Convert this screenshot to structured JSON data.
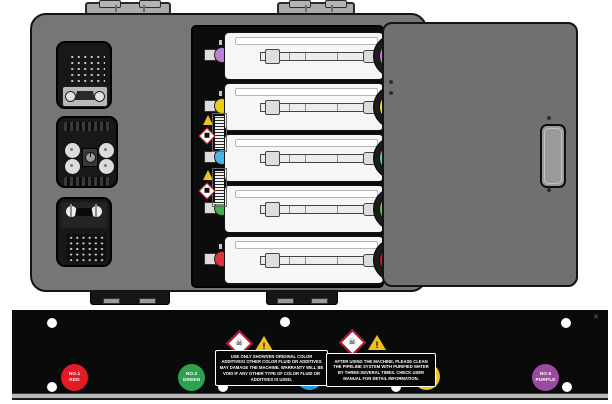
{
  "machine": {
    "type_note": "five-color fluid pump bay diagram",
    "cartridge_rows": [
      {
        "position": 1,
        "color_name": "purple",
        "connector_hex": "#d46fe3",
        "ball_hex": "#bb7fd6"
      },
      {
        "position": 2,
        "color_name": "yellow",
        "connector_hex": "#f0e40e",
        "ball_hex": "#e6cf12"
      },
      {
        "position": 3,
        "color_name": "cyan",
        "connector_hex": "#38d6d6",
        "ball_hex": "#4db4e6"
      },
      {
        "position": 4,
        "color_name": "green",
        "connector_hex": "#67c531",
        "ball_hex": "#3fae4d"
      },
      {
        "position": 5,
        "color_name": "red",
        "connector_hex": "#e0101f",
        "ball_hex": "#e03340"
      }
    ]
  },
  "bottom_panel": {
    "background": "#0a0a0a",
    "ports": [
      {
        "line1": "NO.1",
        "line2": "RED",
        "hex": "#e21b24"
      },
      {
        "line1": "NO.2",
        "line2": "GREEN",
        "hex": "#2ea14e"
      },
      {
        "line1": "NO.3",
        "line2": "BLUE",
        "hex": "#2a9ddd"
      },
      {
        "line1": "NO.4",
        "line2": "YELLOW",
        "hex": "#ecc426"
      },
      {
        "line1": "NO.5",
        "line2": "PURPLE",
        "hex": "#9a4ba0"
      }
    ],
    "warning_labels": [
      {
        "text": "USE ONLY SHOWVEN ORIGINAL COLOR ADDITIVES! OTHER COLOR FLUID OR ADDITIVES MAY DAMAGE THE MACHINE. WARRANTY WILL BE VOID IF ANY OTHER TYPE OF COLOR FLUID OR ADDITIVES IS USED."
      },
      {
        "text": "AFTER USING THE MACHINE, PLEASE CLEAN THE PIPELINE SYSTEM WITH PURIFIED WATER BY THREE-SEVERAL TIMES. CHECK USER MANUAL FOR DETAIL INFORMATION."
      }
    ],
    "icons": {
      "toxic_hazard_glyph": "☠",
      "warning_glyph": "!",
      "corner_mark": "✕"
    }
  }
}
